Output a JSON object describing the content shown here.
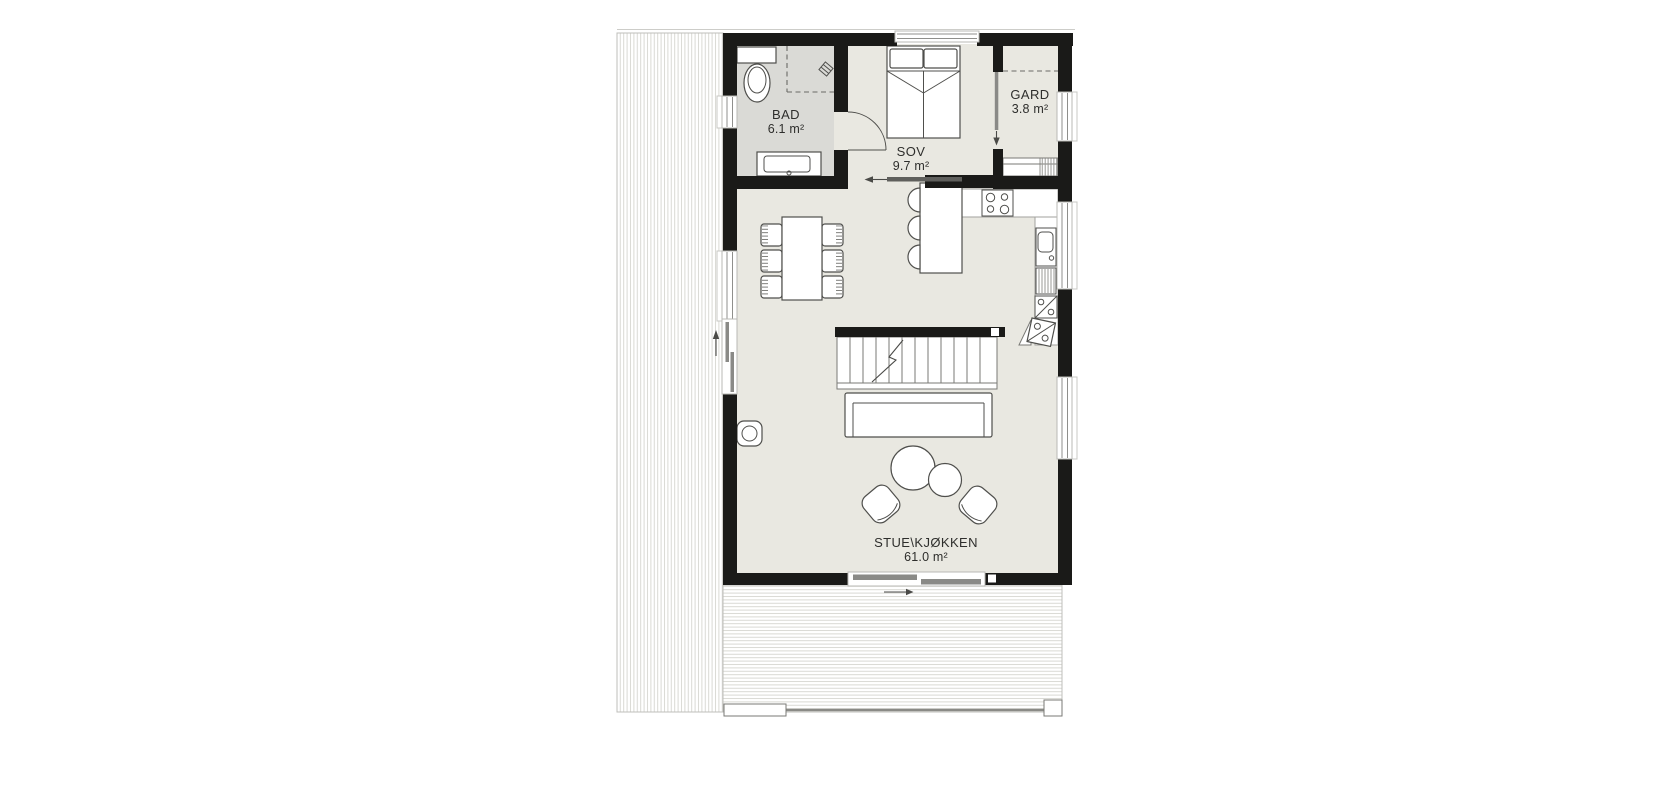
{
  "plan": {
    "rooms": [
      {
        "name": "BAD",
        "area": "6.1 m²"
      },
      {
        "name": "SOV",
        "area": "9.7 m²"
      },
      {
        "name": "GARD",
        "area": "3.8 m²"
      },
      {
        "name": "STUE\\KJØKKEN",
        "area": "61.0 m²"
      }
    ],
    "palette": {
      "wall": "#1a1a18",
      "floor": "#e9e8e1",
      "floor_bad": "#dadad6",
      "deck_hatch": "#d8d8d3",
      "line": "#4f4f4c",
      "text": "#2e2e2c"
    }
  }
}
